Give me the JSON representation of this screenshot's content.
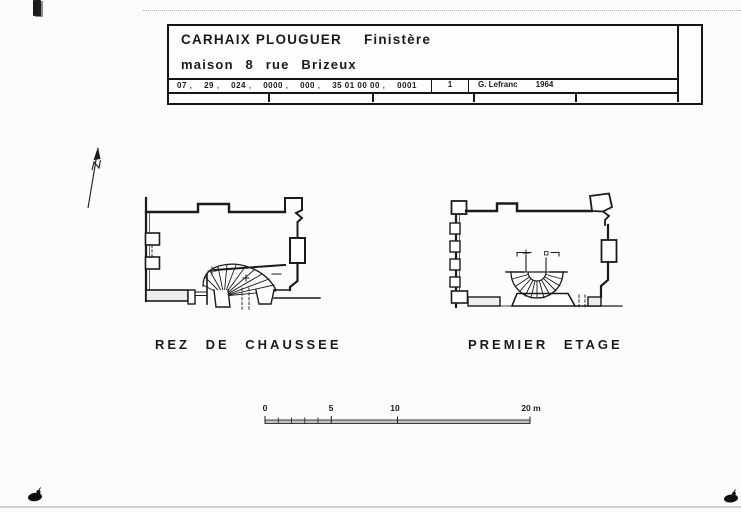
{
  "title_block": {
    "commune": "CARHAIX PLOUGUER",
    "departement": "Finistère",
    "subject": "maison 8 rue Brizeux",
    "code_cells": [
      "07",
      "29",
      "024",
      "0000",
      "000",
      "35 01 00 00",
      "0001"
    ],
    "sheet_number": "1",
    "author": "G. Lefranc",
    "year": "1964"
  },
  "plans": [
    {
      "label": "REZ DE CHAUSSEE"
    },
    {
      "label": "PREMIER ETAGE"
    }
  ],
  "scale_bar": {
    "labels": [
      "0",
      "5",
      "10",
      "20 m"
    ]
  },
  "icons": {
    "north_arrow": "north-arrow"
  },
  "colors": {
    "paper": "#fcfcfa",
    "ink": "#1b1b1b",
    "wall_fill": "#ededed",
    "scan_artifact": "#b3b3b3"
  }
}
